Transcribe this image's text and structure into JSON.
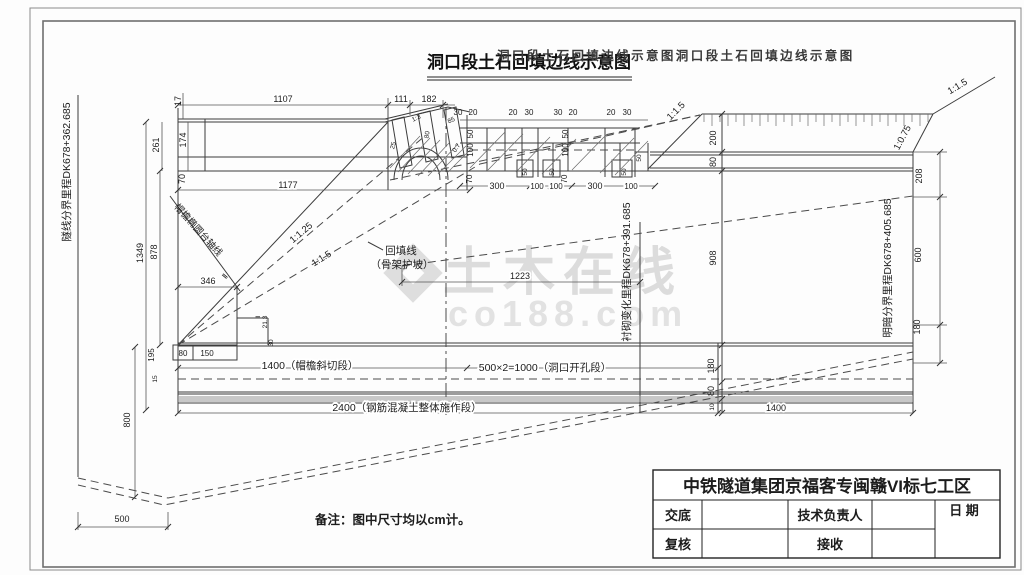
{
  "title": {
    "main": "洞口段土石回填边线示意图",
    "ghost": "洞口段土石回填边线示意图洞口段土石回填边线示意图"
  },
  "watermark": {
    "brand": "土木在线",
    "domain": "co188.com"
  },
  "note": "备注：图中尺寸均以cm计。",
  "annotations": {
    "left_boundary": "隧线分界里程DK678+362.685",
    "lining_change": "衬砌变化里程DK678+391.685",
    "open_cut_boundary": "明暗分界里程DK678+405.685",
    "eave_axis": "帽檐椭圆台轴线",
    "backfill_line": "回填线",
    "backfill_sub": "（骨架护坡）",
    "seg_slant": "1400（帽檐斜切段）",
    "seg_opening": "500×2=1000（洞口开孔段）",
    "seg_monolithic": "2400（钢筋混凝土整体施作段）"
  },
  "slopes": {
    "s125": "1:1.25",
    "s15": "1:1.5",
    "s075": "1:0.75",
    "s13": "1:3"
  },
  "dims": {
    "v10": "10",
    "v15": "15",
    "v17": "17",
    "v20": "20",
    "v213": "21.3",
    "v25": "25",
    "v30": "30",
    "v50": "50",
    "v70": "70",
    "v07": "0.7",
    "v80": "80",
    "v85": "85",
    "v100": "100",
    "v111": "111",
    "v150": "150",
    "v174": "174",
    "v180": "180",
    "v182": "182",
    "v195": "195",
    "v200": "200",
    "v208": "208",
    "v261": "261",
    "v300": "300",
    "v346": "346",
    "v500": "500",
    "v600": "600",
    "v800": "800",
    "v878": "878",
    "v908": "908",
    "v1107": "1107",
    "v1177": "1177",
    "v1223": "1223",
    "v1349": "1349",
    "v1400": "1400",
    "axisII": "Ⅱ"
  },
  "titleblock": {
    "company": "中铁隧道集团京福客专闽赣VI标七工区",
    "jiaodi": "交底",
    "tech_lead": "技术负责人",
    "date": "日 期",
    "fuhe": "复核",
    "jieshou": "接收"
  }
}
